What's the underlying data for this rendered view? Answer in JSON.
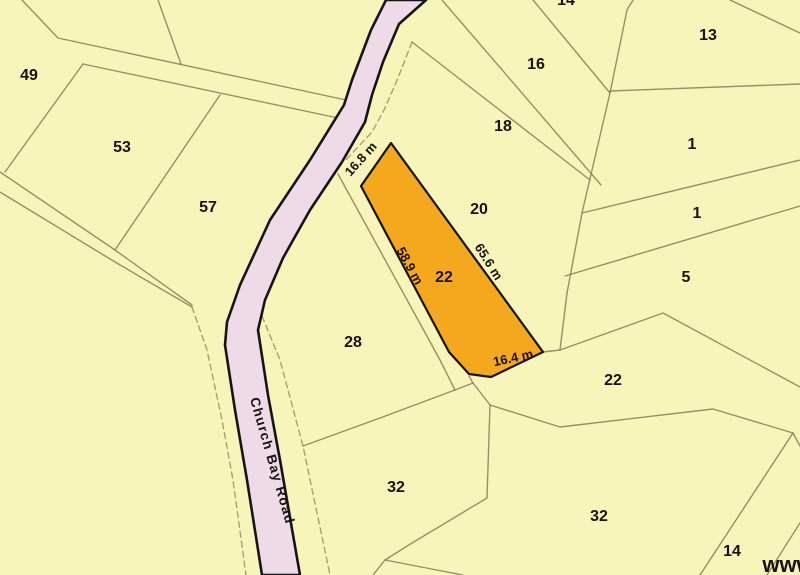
{
  "map": {
    "type": "cadastral-parcel-map",
    "background_color": "#f8f5ba",
    "line_color": "#8a7b58",
    "road": {
      "name": "Church Bay Road",
      "fill": "#eedbe7",
      "outline_color": "#151515",
      "label_color": "#2e2a28"
    },
    "highlight_parcel": {
      "number": "22",
      "fill": "#f4a81d",
      "outline_color": "#151515",
      "dimensions": [
        "16.8 m",
        "58.9 m",
        "65.6 m",
        "16.4 m"
      ]
    },
    "watermark": "www",
    "labels": [
      {
        "name": "parcel-label-49",
        "text": "49",
        "x": 29,
        "y": 80,
        "rot": 0,
        "size": 16
      },
      {
        "name": "parcel-label-53",
        "text": "53",
        "x": 122,
        "y": 152,
        "rot": 0,
        "size": 16
      },
      {
        "name": "parcel-label-57",
        "text": "57",
        "x": 208,
        "y": 212,
        "rot": 0,
        "size": 16
      },
      {
        "name": "parcel-label-16",
        "text": "16",
        "x": 536,
        "y": 69,
        "rot": 0,
        "size": 16
      },
      {
        "name": "parcel-label-18",
        "text": "18",
        "x": 503,
        "y": 131,
        "rot": 0,
        "size": 16
      },
      {
        "name": "parcel-label-20",
        "text": "20",
        "x": 479,
        "y": 214,
        "rot": 0,
        "size": 16
      },
      {
        "name": "parcel-label-22-highlight",
        "text": "22",
        "x": 444,
        "y": 282,
        "rot": 0,
        "size": 16
      },
      {
        "name": "parcel-label-28",
        "text": "28",
        "x": 353,
        "y": 347,
        "rot": 0,
        "size": 16
      },
      {
        "name": "parcel-label-13",
        "text": "13",
        "x": 708,
        "y": 40,
        "rot": 0,
        "size": 16
      },
      {
        "name": "parcel-label-1a",
        "text": "1",
        "x": 692,
        "y": 149,
        "rot": 0,
        "size": 16
      },
      {
        "name": "parcel-label-1b",
        "text": "1",
        "x": 697,
        "y": 218,
        "rot": 0,
        "size": 16
      },
      {
        "name": "parcel-label-5",
        "text": "5",
        "x": 686,
        "y": 282,
        "rot": 0,
        "size": 16
      },
      {
        "name": "parcel-label-22-east",
        "text": "22",
        "x": 613,
        "y": 385,
        "rot": 0,
        "size": 16
      },
      {
        "name": "parcel-label-32-west",
        "text": "32",
        "x": 396,
        "y": 492,
        "rot": 0,
        "size": 16
      },
      {
        "name": "parcel-label-32-east",
        "text": "32",
        "x": 599,
        "y": 521,
        "rot": 0,
        "size": 16
      },
      {
        "name": "parcel-label-14",
        "text": "14",
        "x": 732,
        "y": 556,
        "rot": 0,
        "size": 16
      },
      {
        "name": "parcel-label-14-clipped-top",
        "text": "14",
        "x": 566,
        "y": 5,
        "rot": 0,
        "size": 16
      },
      {
        "name": "dimension-label-16-8-m",
        "text": "16.8 m",
        "x": 364,
        "y": 162,
        "rot": -48,
        "size": 13
      },
      {
        "name": "dimension-label-58-9-m",
        "text": "58.9 m",
        "x": 406,
        "y": 268,
        "rot": 61,
        "size": 13
      },
      {
        "name": "dimension-label-65-6-m",
        "text": "65.6 m",
        "x": 485,
        "y": 264,
        "rot": 58,
        "size": 13
      },
      {
        "name": "dimension-label-16-4-m",
        "text": "16.4 m",
        "x": 514,
        "y": 362,
        "rot": -12,
        "size": 13
      },
      {
        "name": "road-name-label",
        "text": "Church Bay Road",
        "x": 268,
        "y": 462,
        "rot": 74,
        "size": 13.5,
        "spacing": 1.2,
        "color": "#2e2a28"
      },
      {
        "name": "watermark-text",
        "text": "www",
        "x": 788,
        "y": 572,
        "rot": 0,
        "size": 22,
        "color": "#181208"
      }
    ]
  }
}
